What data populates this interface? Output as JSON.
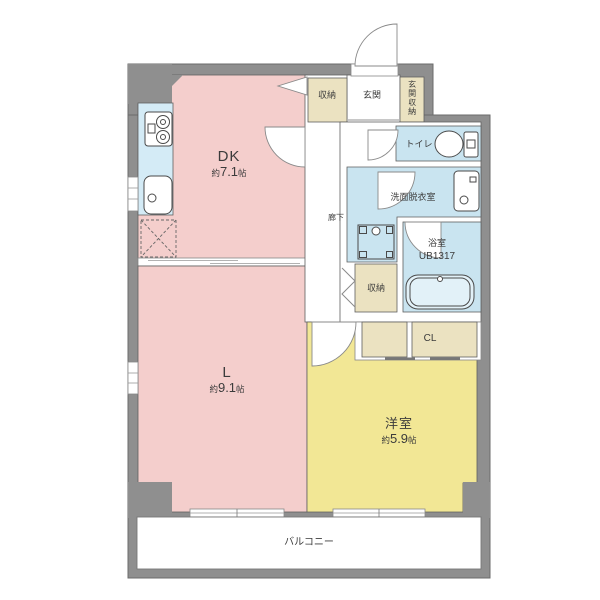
{
  "plan_title": "1LDK apartment floor plan",
  "colors": {
    "wall": "#8f8f8f",
    "wallline": "#6b6b6b",
    "line": "#5f5f5f",
    "pink": "#f4cecc",
    "yellow": "#f2e795",
    "wet": "#c9e4f0",
    "kitchen": "#d4ebf6",
    "cream": "#ebe2c1",
    "fixture": "#4a4a4a"
  },
  "rooms": {
    "dk": {
      "label": "DK",
      "area_prefix": "約",
      "area_value": "7.1",
      "area_unit": "帖"
    },
    "living": {
      "label": "L",
      "area_prefix": "約",
      "area_value": "9.1",
      "area_unit": "帖"
    },
    "western": {
      "label": "洋室",
      "area_prefix": "約",
      "area_value": "5.9",
      "area_unit": "帖"
    },
    "entrance": {
      "label": "玄関"
    },
    "entrance_storage": {
      "label": "玄関収納"
    },
    "storage_top": {
      "label": "収納"
    },
    "toilet": {
      "label": "トイレ"
    },
    "washroom": {
      "label": "洗面脱衣室"
    },
    "bathroom": {
      "label": "浴室",
      "model": "UB1317"
    },
    "storage_hall": {
      "label": "収納"
    },
    "closet": {
      "label": "CL"
    },
    "hallway": {
      "label": "廊下"
    },
    "balcony": {
      "label": "バルコニー"
    }
  }
}
